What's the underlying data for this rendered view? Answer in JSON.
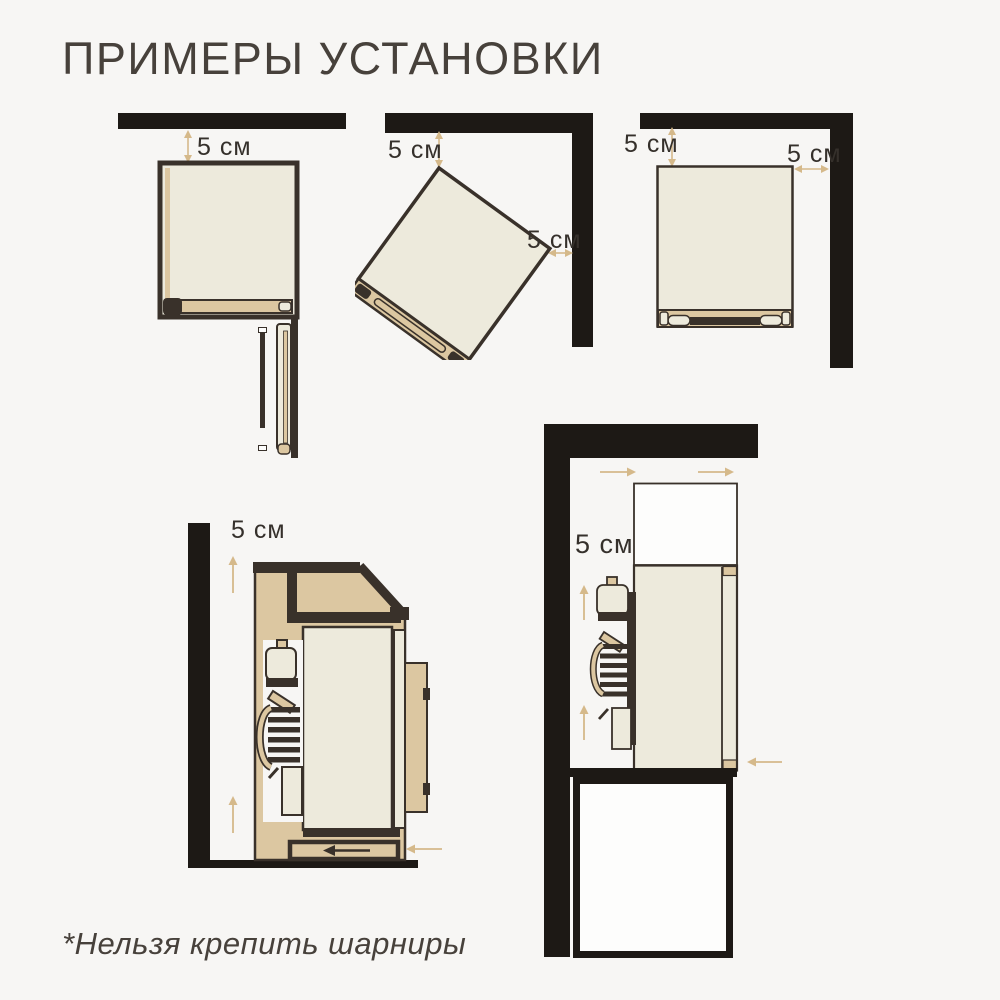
{
  "page": {
    "title": "ПРИМЕРЫ УСТАНОВКИ",
    "footnote": "*Нельзя крепить шарниры"
  },
  "colors": {
    "background": "#f7f6f4",
    "wall_black": "#1d1915",
    "outline_dark": "#39312a",
    "device_body_cream": "#edeadc",
    "device_trim_tan": "#dcc7a1",
    "dimension_arrow_beige": "#d5b98a",
    "text": "#47413b"
  },
  "diagrams": [
    {
      "name": "top-view-device-under-wall",
      "labels": {
        "top_gap": "5 см"
      }
    },
    {
      "name": "top-view-device-tilted-in-corner",
      "labels": {
        "top_gap": "5 см",
        "side_gap": "5 см"
      }
    },
    {
      "name": "top-view-device-straight-in-corner",
      "labels": {
        "top_gap": "5 см",
        "side_gap": "5 см"
      }
    },
    {
      "name": "side-view-device-beside-wall",
      "labels": {
        "wall_gap": "5 см"
      }
    },
    {
      "name": "side-view-device-above-niche",
      "labels": {
        "wall_gap": "5 см"
      }
    }
  ]
}
